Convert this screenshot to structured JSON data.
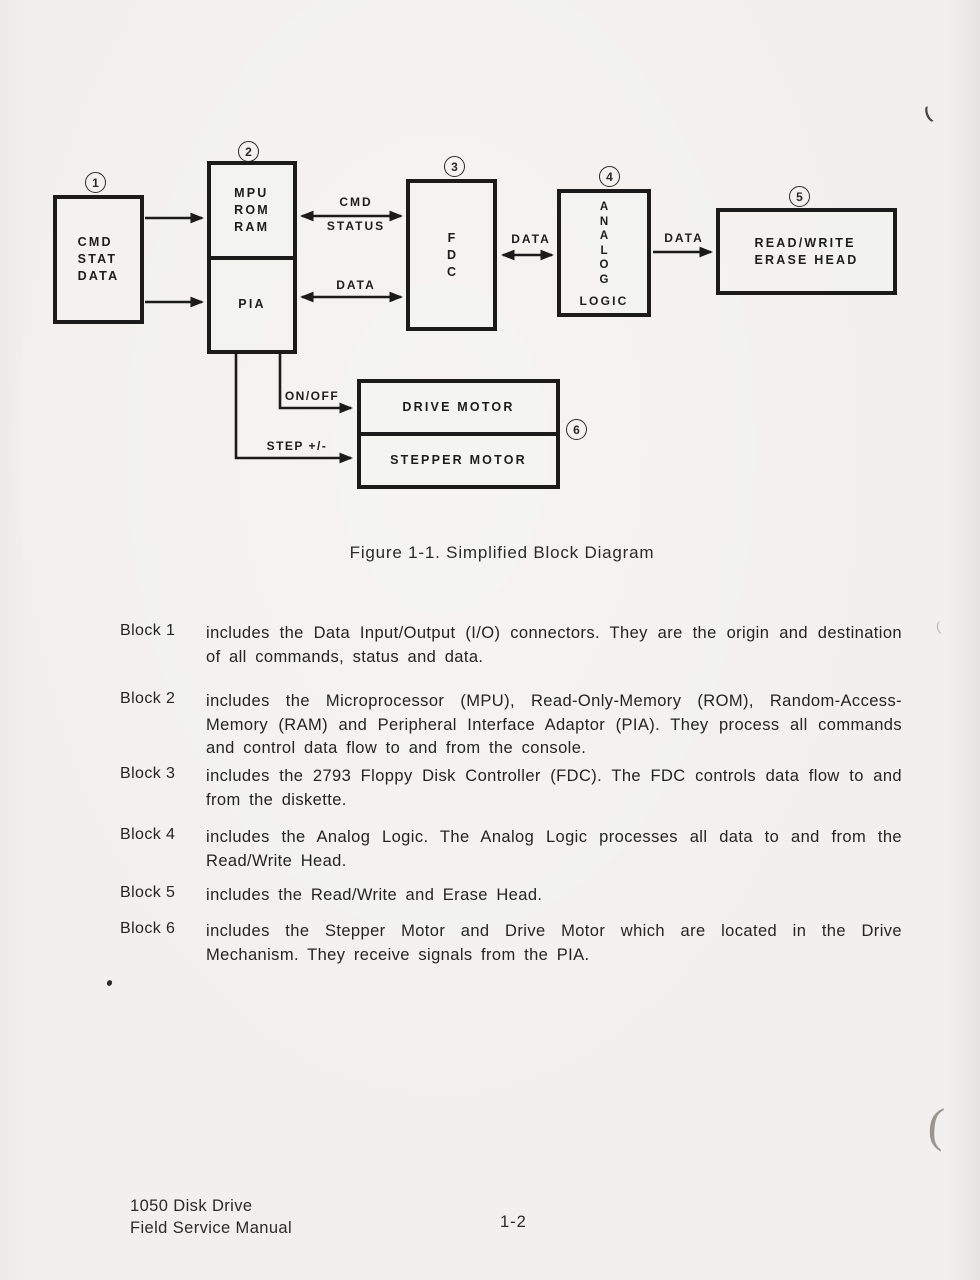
{
  "colors": {
    "paper": "#f1f0ee",
    "ink": "#1b1b1b"
  },
  "figure": {
    "caption": "Figure 1-1. Simplified Block Diagram"
  },
  "diagram": {
    "blocks": {
      "io": {
        "number": "1",
        "label": "CMD\nSTAT\nDATA"
      },
      "mpu": {
        "number": "2",
        "top_label": "MPU\nROM\nRAM",
        "bottom_label": "PIA"
      },
      "fdc": {
        "number": "3",
        "label": "F\nD\nC"
      },
      "analog": {
        "number": "4",
        "vertical_label": "A\nN\nA\nL\nO\nG",
        "bottom_label": "LOGIC"
      },
      "head": {
        "number": "5",
        "label": "READ/WRITE\nERASE HEAD"
      },
      "motors": {
        "number": "6",
        "drive_label": "DRIVE MOTOR",
        "stepper_label": "STEPPER MOTOR"
      }
    },
    "wire_labels": {
      "cmd": "CMD",
      "status": "STATUS",
      "data_pia": "DATA",
      "data_analog": "DATA",
      "data_head": "DATA",
      "on_off": "ON/OFF",
      "step": "STEP +/-"
    }
  },
  "descriptions": [
    {
      "label": "Block 1",
      "text": "includes the Data Input/Output (I/O) connectors.  They are the origin and destination of all commands, status and data."
    },
    {
      "label": "Block 2",
      "text": "includes the Microprocessor (MPU), Read-Only-Memory (ROM), Random-Access-Memory (RAM) and Peripheral Interface Adaptor (PIA).  They process all commands and control data flow to and from the console."
    },
    {
      "label": "Block 3",
      "text": "includes the 2793 Floppy Disk Controller (FDC).  The FDC controls data flow to and from the diskette."
    },
    {
      "label": "Block 4",
      "text": "includes the Analog Logic.  The Analog Logic processes all data to and from the Read/Write Head."
    },
    {
      "label": "Block 5",
      "text": "includes the Read/Write and Erase Head."
    },
    {
      "label": "Block 6",
      "text": "includes the Stepper Motor and Drive Motor which are located in the Drive Mechanism.  They receive signals from the PIA."
    }
  ],
  "footer": {
    "manual_title": "1050 Disk Drive\nField Service Manual",
    "page_number": "1-2"
  },
  "artifacts": {
    "paren_mark": "("
  }
}
